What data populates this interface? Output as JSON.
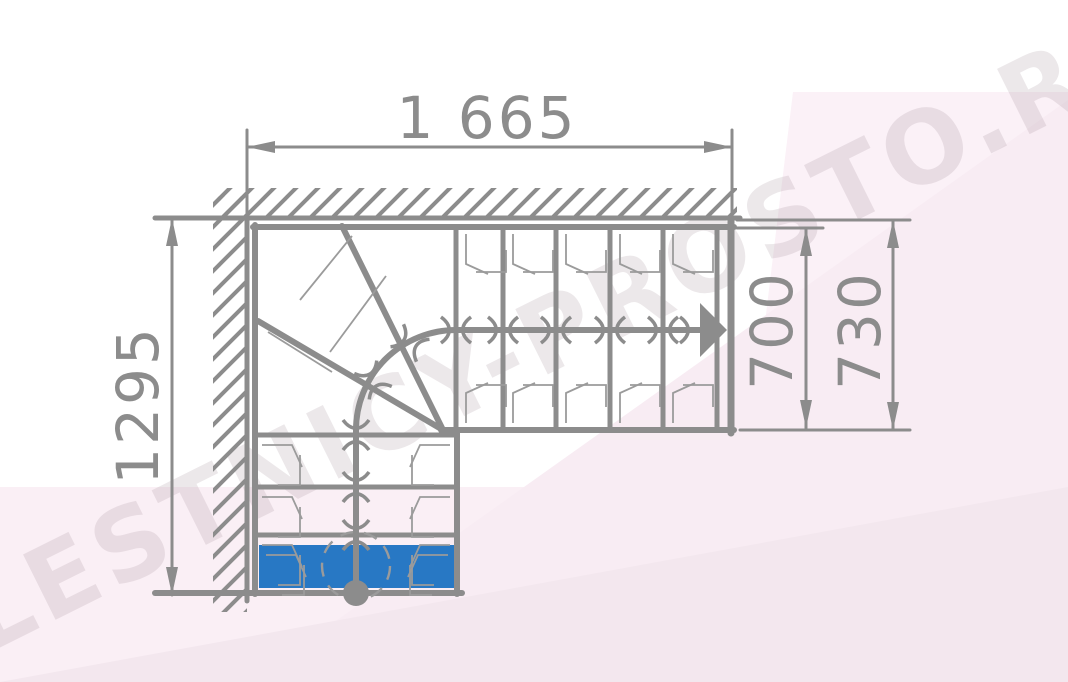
{
  "title": "L-shaped staircase plan with winder steps",
  "dimensions": {
    "width_top": "1 665",
    "height_left": "1295",
    "flight_width_inner": "700",
    "flight_width_outer": "730"
  },
  "watermark": {
    "text": "LESTNICY-PROSTO.RU"
  },
  "colors": {
    "line": "#8c8c8c",
    "thin_line": "#9b9b9b",
    "step_highlight": "#2878c4",
    "watermark": "rgba(158,142,152,0.20)",
    "bg_top_right": "#fbf1f7",
    "bg_band": "#f8ecf3",
    "bg_bottom": "#faeff5",
    "bg_bottom_overlay": "#f3e7ee"
  }
}
